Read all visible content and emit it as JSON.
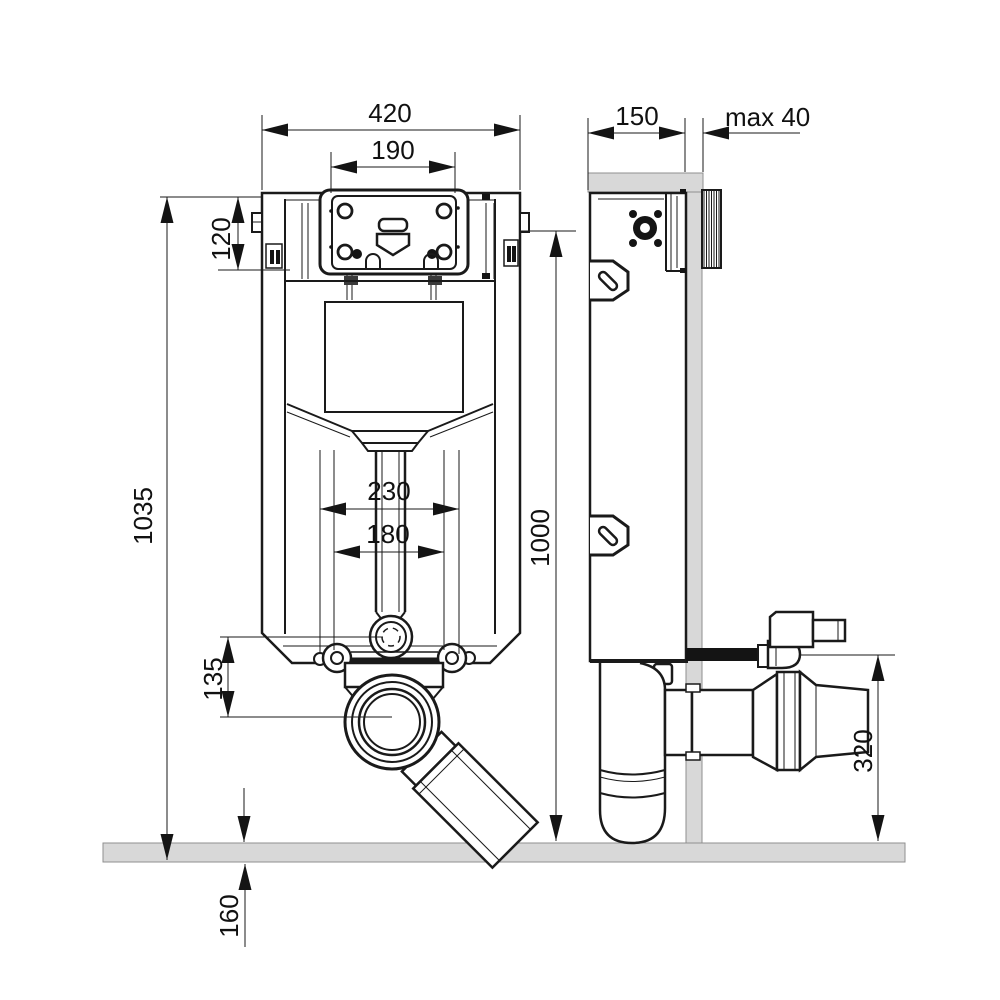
{
  "drawing": {
    "subject": "Concealed WC cistern mounting frame installation drawing",
    "views": {
      "left": "front view",
      "right": "side view"
    },
    "units": "mm"
  },
  "dims": {
    "frame_width": "420",
    "flush_opening_width": "190",
    "frame_depth": "150",
    "wall_finish": "max 40",
    "flush_box_height": "120",
    "frame_height": "1035",
    "flush_center_height": "1000",
    "fixing_span_outer": "230",
    "fixing_span_inner": "180",
    "outlet_offset": "135",
    "below_floor": "160",
    "outlet_height": "320"
  },
  "colors": {
    "line": "#1a1a1a",
    "wall_fill": "#d8d8d8",
    "floor_fill": "#d8d8d8",
    "background": "#ffffff"
  }
}
